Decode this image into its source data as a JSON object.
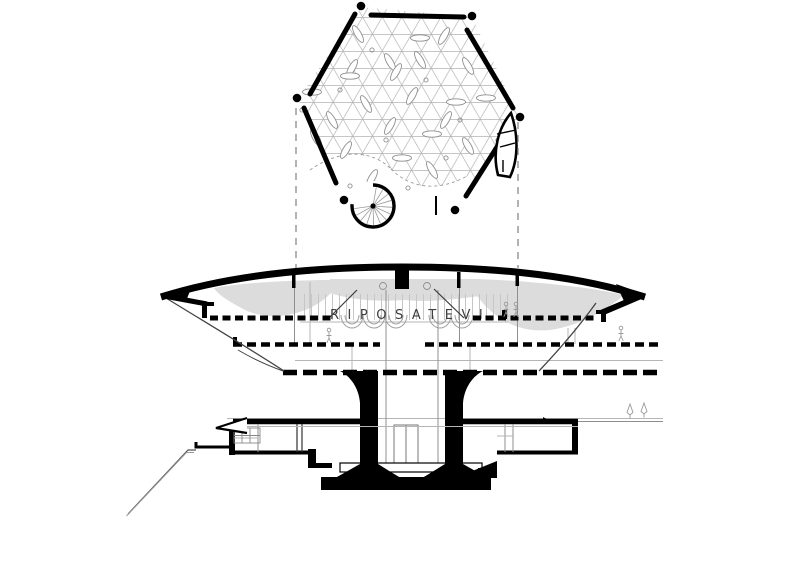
{
  "drawing": {
    "kind": "architectural plan and section, black ink on white",
    "sign_text": "RIPOSATEVI",
    "colors": {
      "ink": "#000000",
      "grid_gray": "#b4b4b4",
      "shade_gray": "#dcdcdc",
      "sketch_gray": "#8f8f8f",
      "background": "#ffffff"
    },
    "plan": {
      "description": "hexagonal roof plan with triangular grid, spiral stair, corner columns",
      "spiral_stair": {
        "cx": 373,
        "cy": 206,
        "arc_r": 21,
        "tread_r": 19,
        "tread_count": 13
      },
      "scatter_marks": [
        [
          352,
          68,
          -60
        ],
        [
          390,
          62,
          60
        ],
        [
          420,
          38,
          0
        ],
        [
          358,
          34,
          60
        ],
        [
          444,
          36,
          -60
        ],
        [
          420,
          60,
          60
        ],
        [
          350,
          76,
          0
        ],
        [
          396,
          72,
          -60
        ],
        [
          468,
          66,
          60
        ],
        [
          312,
          92,
          0
        ],
        [
          366,
          104,
          60
        ],
        [
          412,
          96,
          -60
        ],
        [
          456,
          102,
          0
        ],
        [
          332,
          120,
          60
        ],
        [
          390,
          126,
          -60
        ],
        [
          432,
          134,
          0
        ],
        [
          468,
          146,
          60
        ],
        [
          346,
          150,
          -60
        ],
        [
          402,
          158,
          0
        ],
        [
          316,
          138,
          60
        ],
        [
          372,
          178,
          -60
        ],
        [
          432,
          170,
          60
        ],
        [
          486,
          98,
          0
        ],
        [
          446,
          120,
          -60
        ]
      ],
      "scatter_dots": [
        [
          372,
          50
        ],
        [
          340,
          90
        ],
        [
          426,
          80
        ],
        [
          302,
          110
        ],
        [
          386,
          140
        ],
        [
          460,
          120
        ],
        [
          350,
          186
        ],
        [
          408,
          188
        ],
        [
          446,
          158
        ],
        [
          498,
          140
        ]
      ]
    },
    "section": {
      "sign_text": "RIPOSATEVI",
      "people": [
        [
          329,
          330
        ],
        [
          506,
          304
        ],
        [
          516,
          304
        ],
        [
          621,
          328
        ]
      ],
      "trees": [
        [
          630,
          404
        ],
        [
          644,
          403
        ]
      ]
    }
  }
}
